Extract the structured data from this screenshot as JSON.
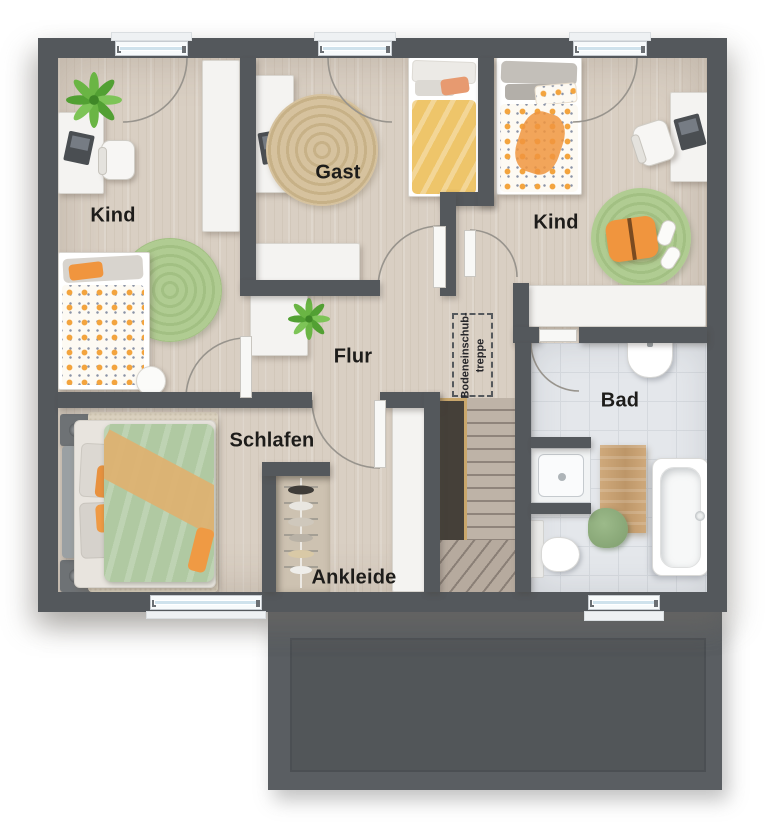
{
  "rooms": {
    "kind_left": {
      "label": "Kind"
    },
    "gast": {
      "label": "Gast"
    },
    "kind_right": {
      "label": "Kind"
    },
    "flur": {
      "label": "Flur"
    },
    "schlafen": {
      "label": "Schlafen"
    },
    "ankleide": {
      "label": "Ankleide"
    },
    "bad": {
      "label": "Bad"
    }
  },
  "attic_ladder": {
    "line1": "Bodeneinschub-",
    "line2": "treppe"
  },
  "colors": {
    "wall": "#54585c",
    "floor_wood": "#d9cfc3",
    "floor_tile": "#e4e7eb",
    "window_glass": "#cfe2ec",
    "rug_green": "#aac78c",
    "rug_jute": "#d2bd97",
    "accent_orange": "#f0953e",
    "duvet_yellow": "#eec56a",
    "duvet_green": "#b0c9a2",
    "stair_tread": "#beb3a7",
    "stair_void": "#454039",
    "railing_gold": "#c9a76c",
    "extension": "#5a5e62"
  }
}
